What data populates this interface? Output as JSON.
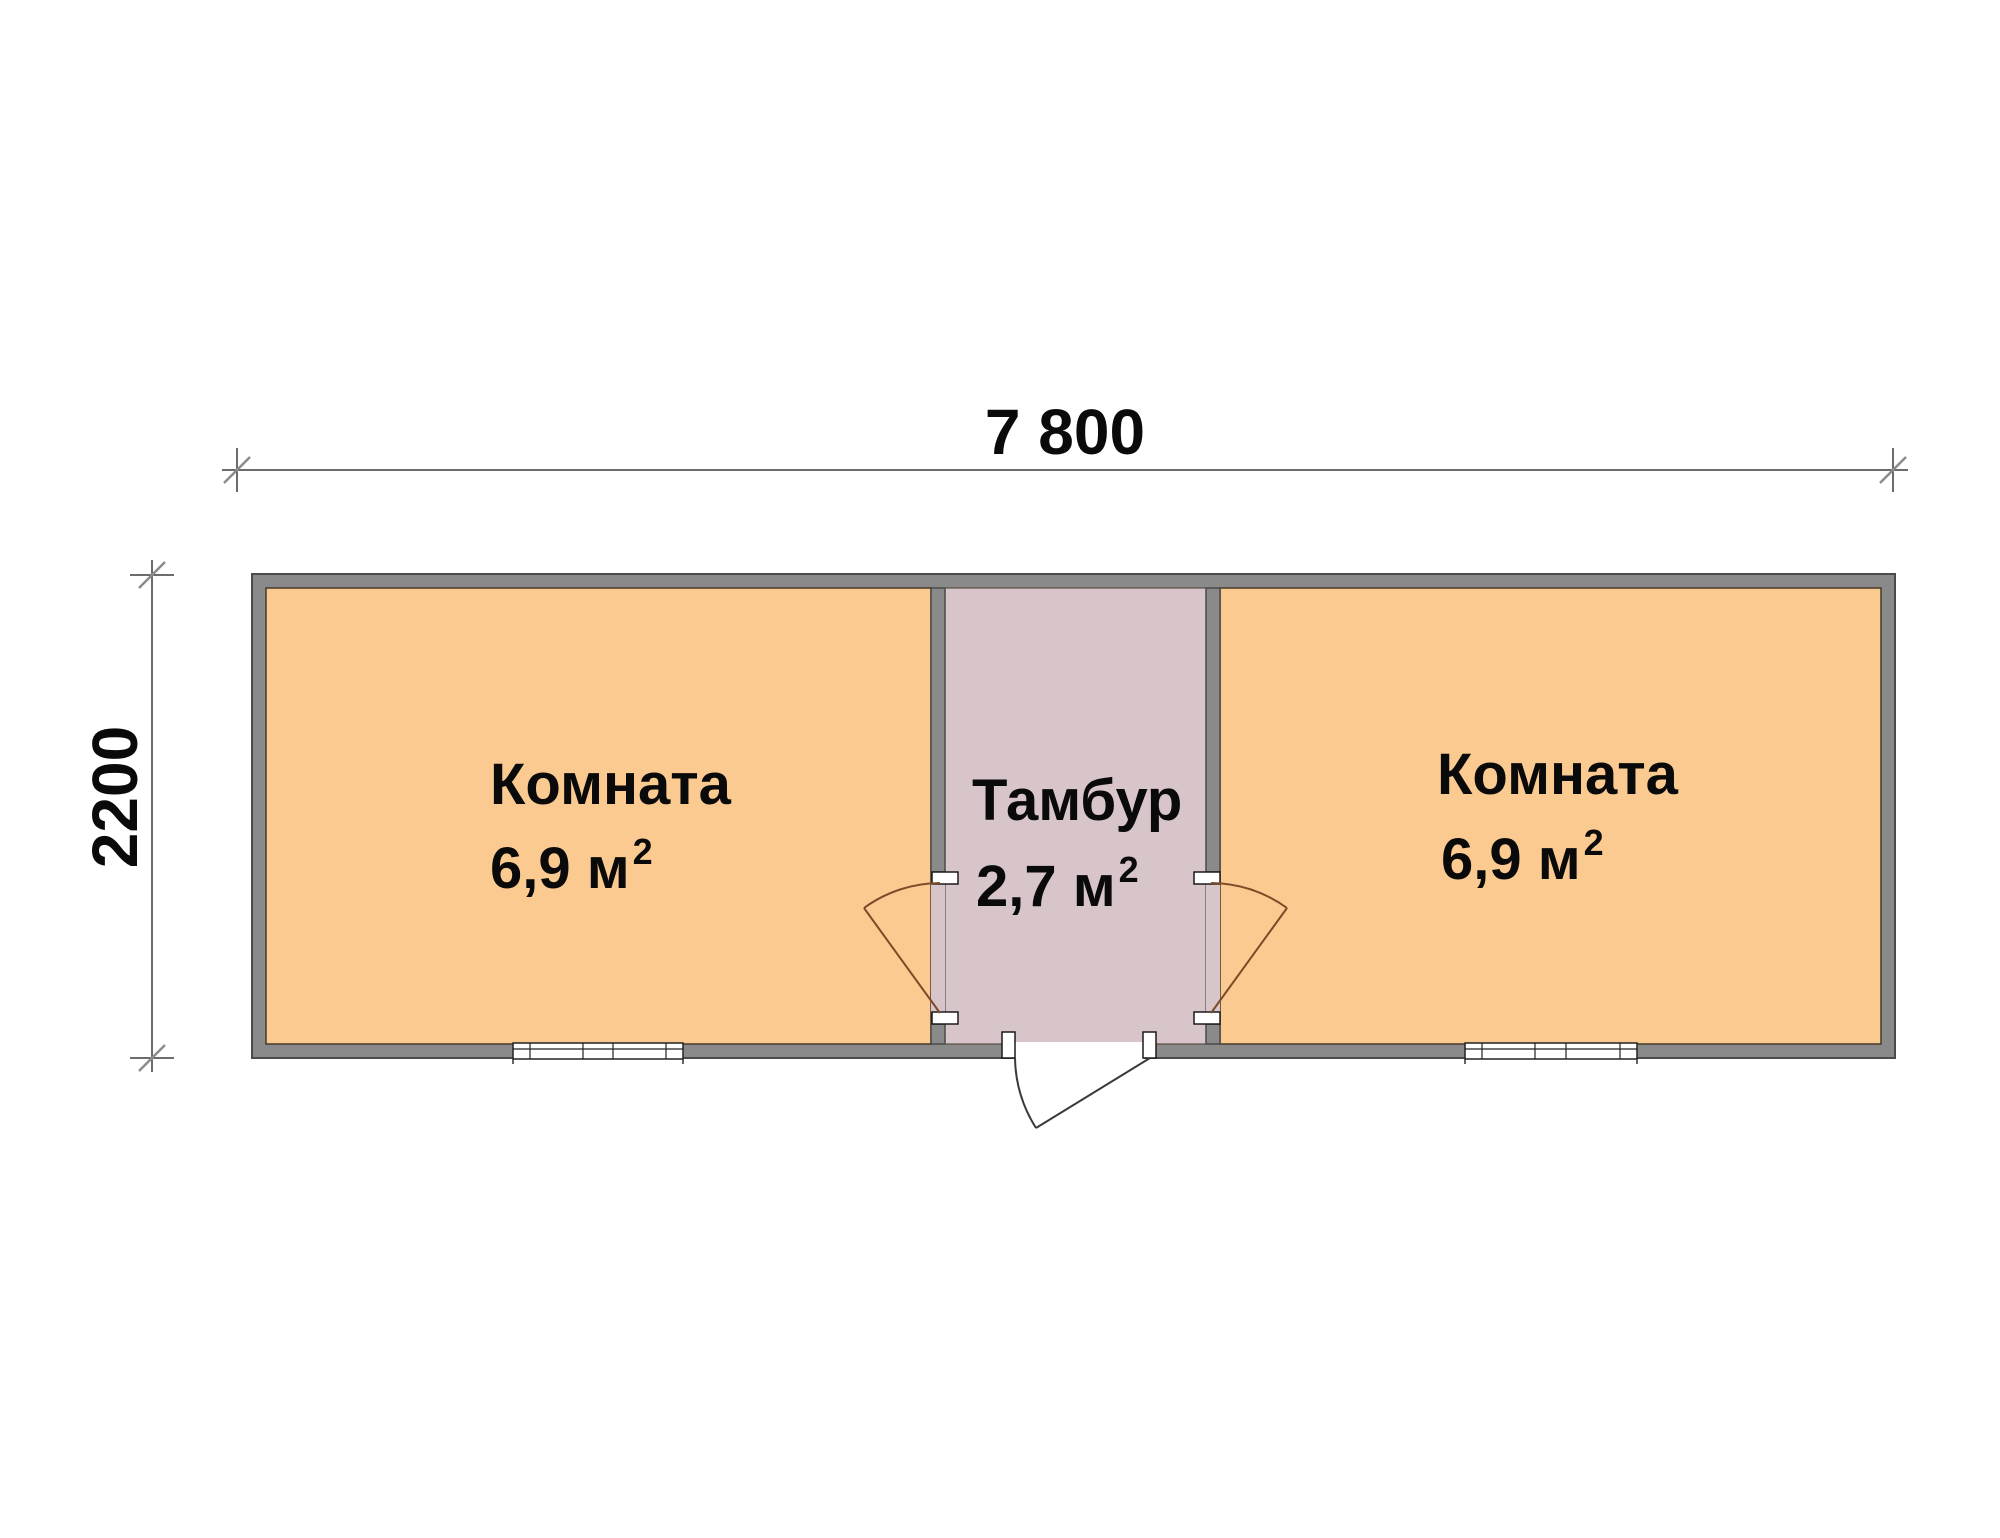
{
  "floor_plan": {
    "dimensions": {
      "width_label": "7 800",
      "height_label": "2200"
    },
    "rooms": [
      {
        "id": "room-left",
        "name": "Комната",
        "area_label": "6,9 м",
        "area_exponent": "2"
      },
      {
        "id": "vestibule",
        "name": "Тамбур",
        "area_label": "2,7 м",
        "area_exponent": "2"
      },
      {
        "id": "room-right",
        "name": "Комната",
        "area_label": "6,9 м",
        "area_exponent": "2"
      }
    ],
    "colors": {
      "room_fill": "#FACA91",
      "vestibule_fill": "#D8C5CA",
      "wall_fill": "#8A8A8A",
      "wall_outline": "#4A4A4A",
      "door_swing": "#7B4B28"
    }
  }
}
